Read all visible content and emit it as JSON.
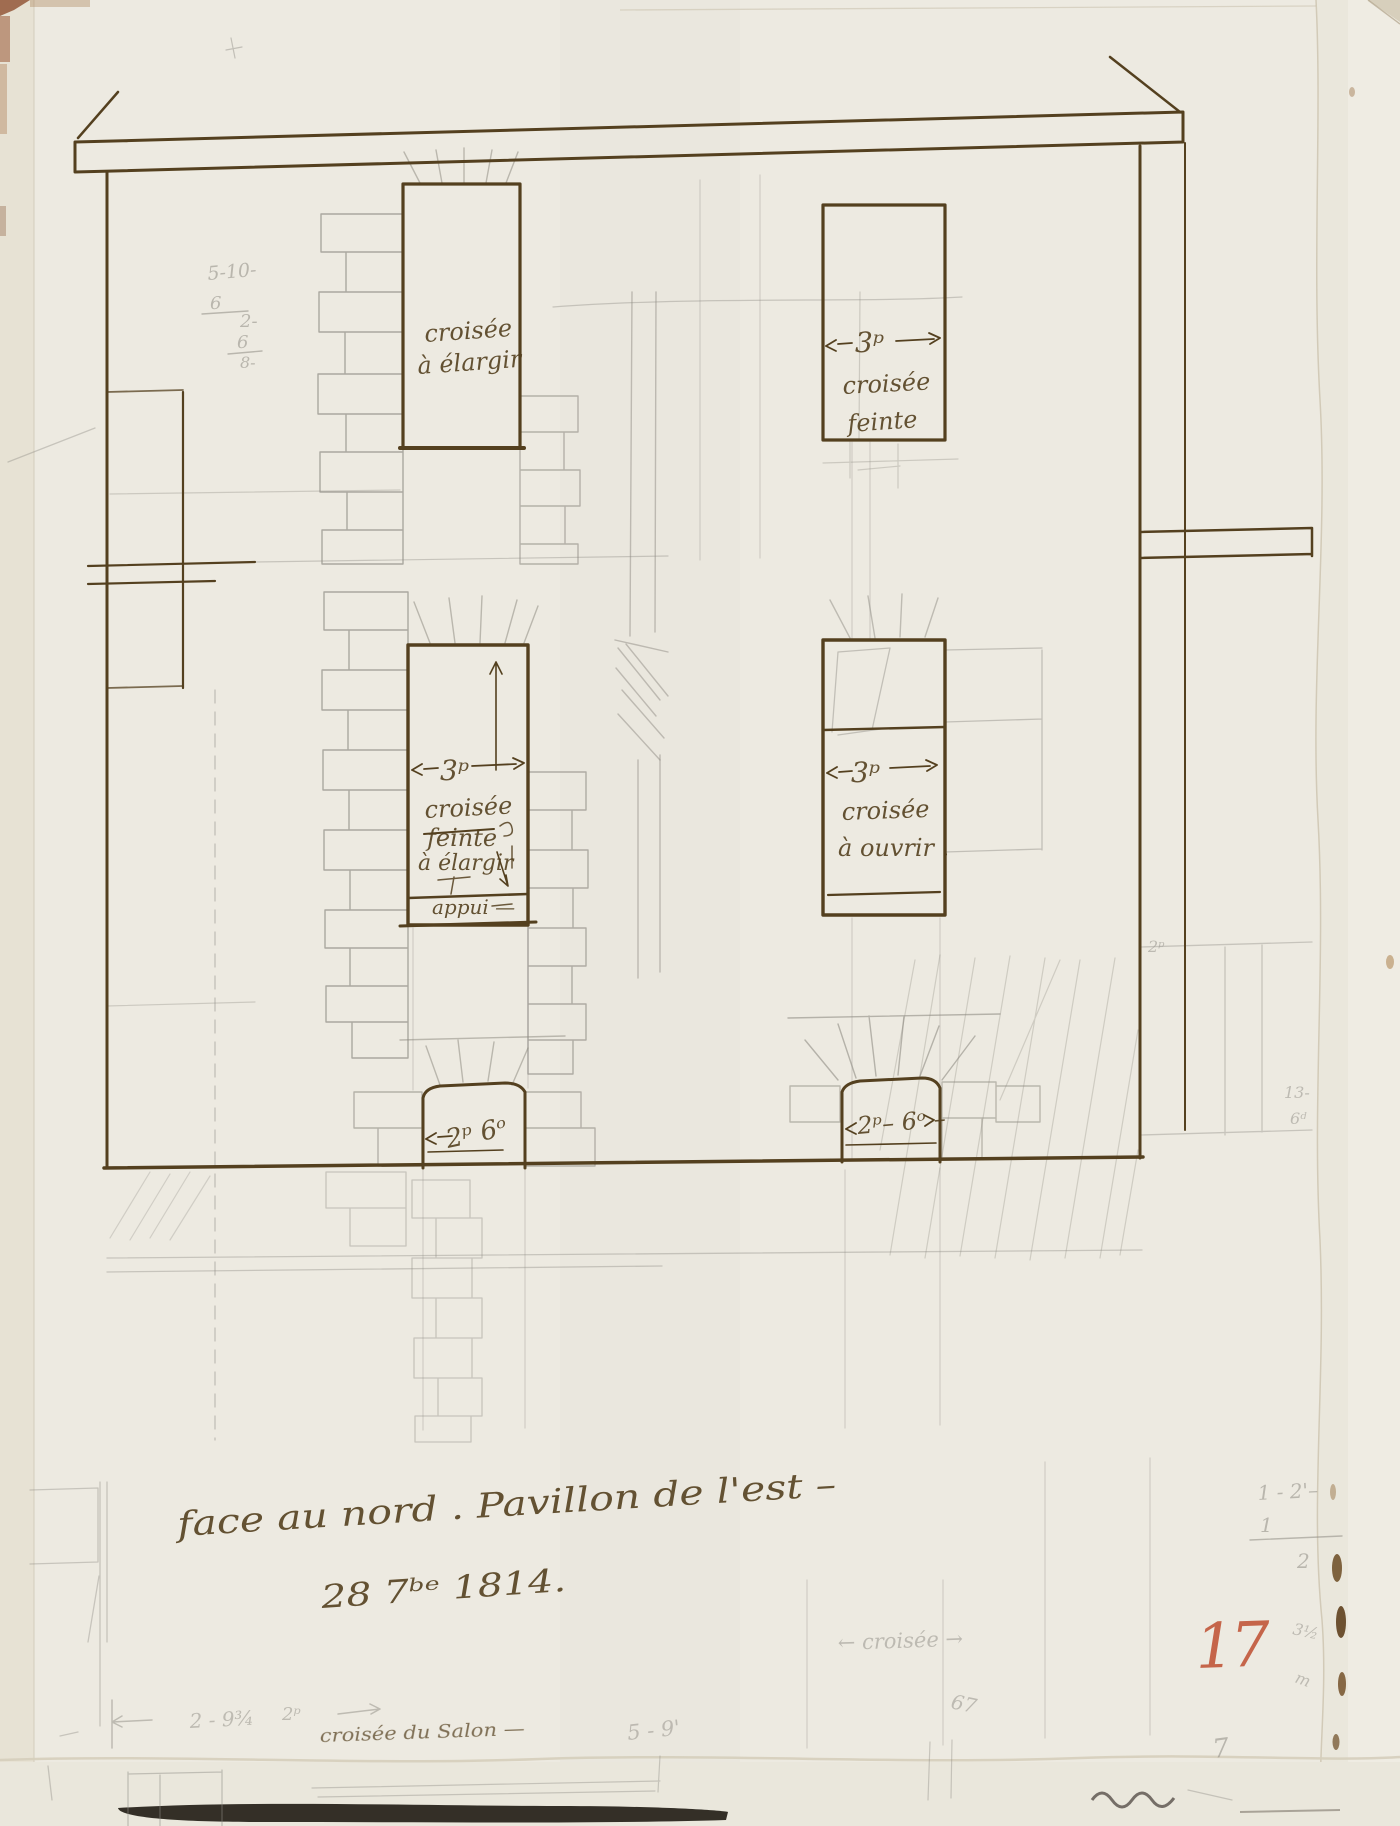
{
  "palette": {
    "paper": "#edeae1",
    "paper_edge": "#e7e2d4",
    "under_sheet": "#eae7dc",
    "ink": "#54401f",
    "ink_light": "#8a6a3a",
    "pencil": "#8f8c84",
    "red_crayon": "#bf4e30"
  },
  "drawing": {
    "windows": {
      "top_left": {
        "line1": "croisée",
        "line2": "à élargir"
      },
      "top_right": {
        "dim": "3ᵖ",
        "line1": "croisée",
        "line2": "feinte"
      },
      "middle_left": {
        "dim": "3ᵖ",
        "line1": "croisée",
        "struck": "feinte",
        "line2": "à élargir",
        "sill": "appui —"
      },
      "middle_right": {
        "dim": "3ᵖ",
        "line1": "croisée",
        "line2": "à ouvrir ."
      },
      "door_left": {
        "dim": "2ᵖ 6ᵒ"
      },
      "door_right": {
        "dim": "2ᵖ– 6ᵒ –"
      }
    },
    "caption": {
      "line1": "face au nord . Pavillon de l'est –",
      "line2": "28 7ᵇᵉ 1814."
    },
    "ink_notes": {
      "salon": "croisée du Salon —"
    },
    "pencil_notes": {
      "calc_stack": [
        "5-10-",
        "6",
        "2-",
        "6",
        "8-"
      ],
      "note_2p": "2ᵖ",
      "note_13": "13-",
      "note_6d": "6ᵈ",
      "frac_line": "1 - 2'–",
      "frac_num": "1",
      "frac_den": "2",
      "margin_a": "3½",
      "margin_b": "m",
      "ghost": "← croisée →",
      "note_67": "67",
      "note_7": "7",
      "bottom_dim": "2 - 9¾",
      "bottom_unit": "2ᵖ",
      "note_5_9": "5 - 9'"
    },
    "page_number": "17"
  }
}
